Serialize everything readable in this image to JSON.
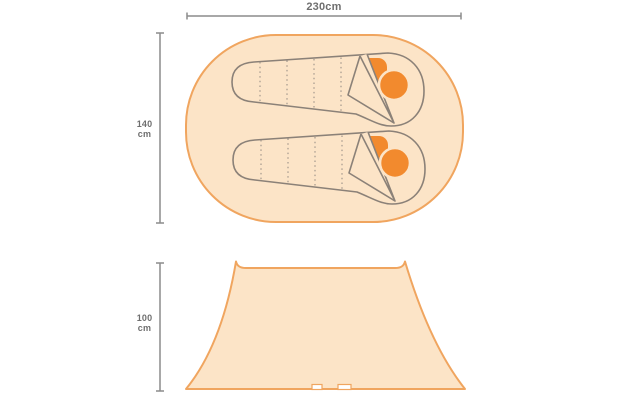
{
  "top_view": {
    "width_label": "230cm",
    "height_label": {
      "value": "140",
      "unit": "cm"
    },
    "sleeping_bag_count": 2
  },
  "side_view": {
    "height_label": {
      "value": "100",
      "unit": "cm"
    }
  },
  "icons": {
    "sleeping_bag": "mummy-sleeping-bag-outline",
    "pillow": "orange-rounded-pillow",
    "head": "orange-circle"
  },
  "colors": {
    "background": "#FFFFFF",
    "tent_fill": "#FCE4C7",
    "tent_outline": "#F0A55F",
    "accent_orange": "#F28A2E",
    "bag_outline": "#8B8178",
    "quilt_line": "#9A9087",
    "dimension_line": "#8C8C8C",
    "dimension_text": "#6E6E6E",
    "notch_fill": "#FFFFFF"
  }
}
